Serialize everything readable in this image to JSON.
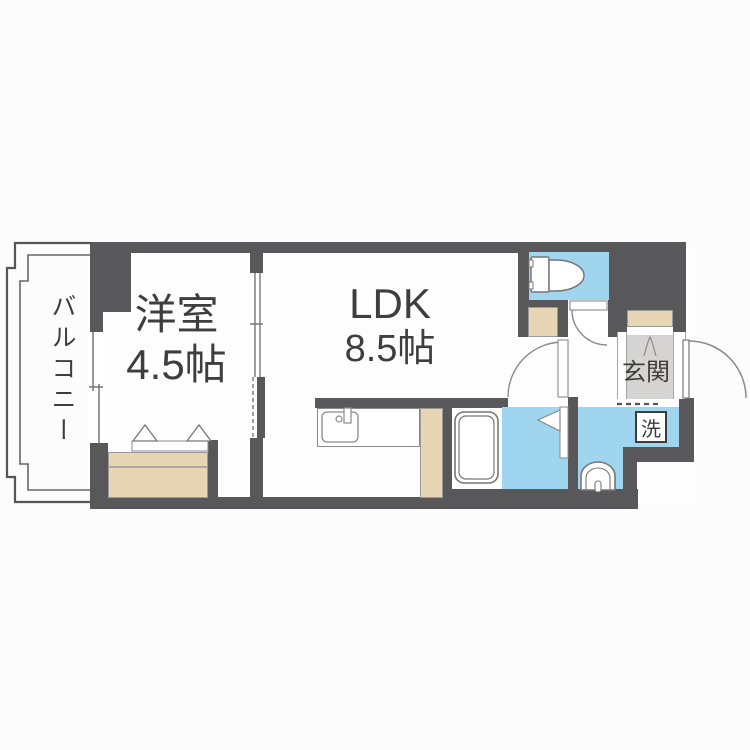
{
  "floorplan": {
    "type": "apartment-floor-plan",
    "rooms": {
      "western": {
        "label": "洋室",
        "size": "4.5帖"
      },
      "ldk": {
        "label": "LDK",
        "size": "8.5帖"
      },
      "balcony": {
        "label": "バルコニー"
      },
      "entrance": {
        "label": "玄関"
      },
      "laundry": {
        "label": "洗"
      }
    },
    "fixtures": {
      "toilet": "toilet",
      "bathtub": "bathtub",
      "kitchen_sink": "kitchen-sink",
      "washbasin": "washbasin",
      "washing_machine_space": "washing-machine-space",
      "closet": "closet",
      "shoe_cabinet": "shoe-cabinet"
    },
    "colors": {
      "wall": "#58585a",
      "wet_area_floor": "#9fd5ee",
      "storage_beige": "#e8d5b4",
      "entrance_floor": "#d6d4d2",
      "room_floor": "#fdfdfd",
      "text": "#3e3e3e"
    }
  }
}
